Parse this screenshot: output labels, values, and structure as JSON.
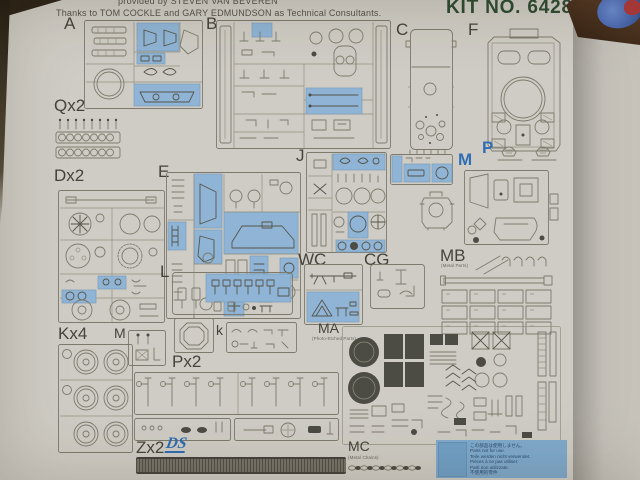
{
  "header": {
    "credit_line_1": "provided by STEVEN VAN BEVEREN",
    "credit_line_2": "Thanks to TOM COCKLE and GARY EDMUNDSON as Technical Consultants.",
    "kit_no": "KIT NO. 6428"
  },
  "sprues": {
    "a": {
      "label": "A"
    },
    "b": {
      "label": "B"
    },
    "c": {
      "label": "C"
    },
    "f": {
      "label": "F"
    },
    "q": {
      "label": "Qx2"
    },
    "d": {
      "label": "Dx2"
    },
    "e": {
      "label": "E"
    },
    "j": {
      "label": "J"
    },
    "m": {
      "label": "M"
    },
    "p": {
      "label": "P"
    },
    "mb": {
      "label": "MB",
      "sublabel": "(Metal Parts)"
    },
    "wc": {
      "label": "WC"
    },
    "cg": {
      "label": "CG"
    },
    "l": {
      "label": "L"
    },
    "k": {
      "label": "k"
    },
    "kx4": {
      "label": "Kx4"
    },
    "m_small": {
      "label": "M"
    },
    "ma": {
      "label": "MA",
      "sublabel": "(Photo-Etched Parts)"
    },
    "px2": {
      "label": "Px2"
    },
    "zx2": {
      "label": "Zx2",
      "logo": "DS"
    },
    "mc": {
      "label": "MC",
      "sublabel": "(Metal Chains)"
    }
  },
  "note_box": {
    "lines": [
      "この部品は使用しません。",
      "Parts not for use.",
      "Teile werden nicht verwendet.",
      "Pièces à ne pas utiliser.",
      "Parti non utilizzate.",
      "不使用的零件"
    ]
  },
  "colors": {
    "sheet_beige": "#e3decd",
    "highlight_blue": "#8fb4d6",
    "kit_no_green": "#2e4c32",
    "blue_label": "#2f6eb5",
    "photo_brown": "#4a3122",
    "photo_gray": "#c6c3bc"
  }
}
